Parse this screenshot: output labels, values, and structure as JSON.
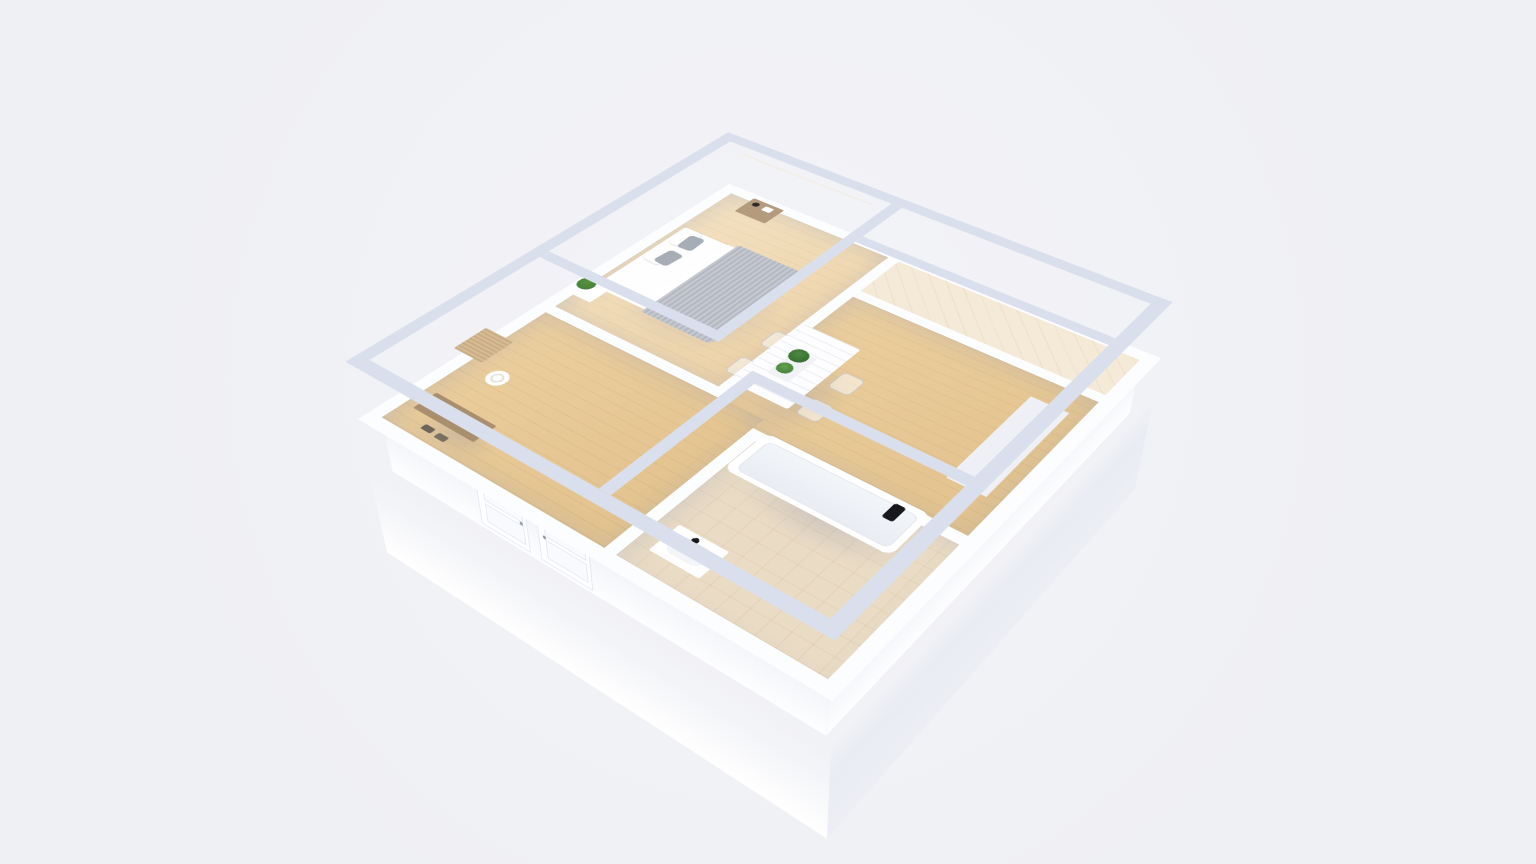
{
  "scene": {
    "type": "3d-floorplan-render",
    "title": "3D cutaway floor plan of a one-bedroom apartment",
    "style": "white walls, pale blue-grey wall caps, light oak wood floors, perspective top-down view",
    "background_color": "#eff0f4"
  },
  "colors": {
    "bg": "#eff0f4",
    "wall_face": "#fcfdff",
    "wall_cap": "#d9dfec",
    "ext_l": "#ffffff",
    "ext_r": "#edeff5",
    "wood_1": "#f4e2c2",
    "wood_2": "#ecd2a9",
    "wood_3": "#eccf9f",
    "wood_4": "#e2c28e",
    "tile_balcony": "#f5ead8",
    "tile_bath": "#eadbc4",
    "blanket_a": "#c6c9d0",
    "blanket_b": "#b4b8c2",
    "headboard": "#c9cbd2",
    "pillow": "#a7adb7",
    "curtain_a": "#eed3c3",
    "curtain_b": "#e0bba5",
    "nightstand": "#b49b7e",
    "plant_a": "#3f7a36",
    "plant_b": "#57923f",
    "bench": "#a98f6d",
    "rattan": "#c9ad85",
    "black": "#17171c",
    "glass_b": "#eef3f8",
    "frame_dk": "#3c3f47"
  },
  "rooms": [
    {
      "id": "bedroom",
      "name": "Bedroom",
      "floor": "light oak planks",
      "furniture": [
        "double bed with white linens and grey knit throw",
        "grey upholstered headboard",
        "white and grey pillows",
        "wooden nightstand with dark vase and white clock",
        "white cube side table with green plant",
        "two tall windows with blush curtains",
        "beige world-map wall art"
      ]
    },
    {
      "id": "living-dining",
      "name": "Living / Dining Room",
      "floor": "oak planks",
      "furniture": [
        "white plank dining table",
        "four transparent ghost chairs",
        "two green potted plants on tray",
        "light sideboard along right wall",
        "white french doors to balcony"
      ]
    },
    {
      "id": "balcony",
      "name": "Balcony",
      "floor": "pale tile",
      "furniture": [
        "continuous glazing band with dark mullions"
      ]
    },
    {
      "id": "hallway",
      "name": "Entry Hallway",
      "floor": "oak planks",
      "furniture": [
        "arched rattan lattice mirror with marble face",
        "cane console cabinet",
        "white round basket",
        "wooden bench with shoes beneath",
        "two panelled closet doors"
      ]
    },
    {
      "id": "bathroom",
      "name": "Bathroom",
      "floor": "beige tile",
      "furniture": [
        "white bathtub",
        "black wall-mounted shower fixture",
        "white washbasin unit with black faucet"
      ]
    }
  ]
}
